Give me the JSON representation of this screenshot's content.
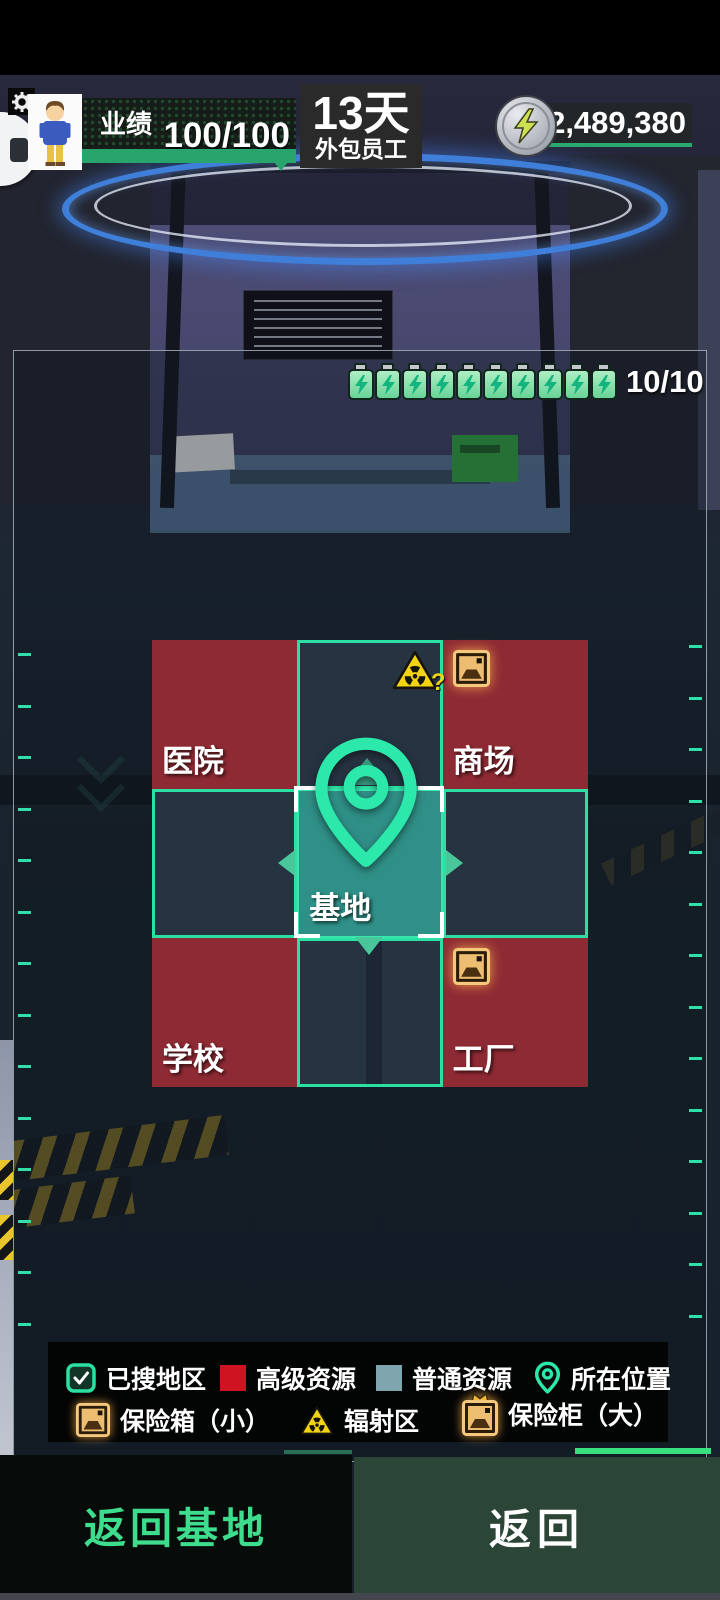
{
  "header": {
    "performance_label": "业绩",
    "performance_value": "100/100",
    "day_count": "13天",
    "day_subtitle": "外包员工",
    "currency_value": "2,489,380"
  },
  "energy": {
    "count": 10,
    "max": 10,
    "text": "10/10"
  },
  "map": {
    "radiation_hint": "?",
    "cells": [
      {
        "row": 0,
        "col": 0,
        "type": "advanced",
        "label": "医院",
        "icons": []
      },
      {
        "row": 0,
        "col": 1,
        "type": "searched",
        "label": "",
        "icons": [
          "radiation-unknown"
        ]
      },
      {
        "row": 0,
        "col": 2,
        "type": "advanced",
        "label": "商场",
        "icons": [
          "safe-small"
        ]
      },
      {
        "row": 1,
        "col": 0,
        "type": "searched",
        "label": "",
        "icons": []
      },
      {
        "row": 1,
        "col": 1,
        "type": "current",
        "label": "基地",
        "icons": []
      },
      {
        "row": 1,
        "col": 2,
        "type": "searched",
        "label": "",
        "icons": []
      },
      {
        "row": 2,
        "col": 0,
        "type": "advanced",
        "label": "学校",
        "icons": []
      },
      {
        "row": 2,
        "col": 1,
        "type": "searched",
        "label": "",
        "icons": []
      },
      {
        "row": 2,
        "col": 2,
        "type": "advanced",
        "label": "工厂",
        "icons": [
          "safe-small"
        ]
      }
    ]
  },
  "legend": {
    "items": [
      {
        "icon": "searched-checkbox",
        "label": "已搜地区"
      },
      {
        "icon": "advanced-swatch",
        "label": "高级资源"
      },
      {
        "icon": "normal-swatch",
        "label": "普通资源"
      },
      {
        "icon": "location-pin",
        "label": "所在位置"
      },
      {
        "icon": "safe-small",
        "label": "保险箱（小）"
      },
      {
        "icon": "radiation",
        "label": "辐射区"
      },
      {
        "icon": "safe-large",
        "label": "保险柜（大）"
      }
    ]
  },
  "footer": {
    "return_base_label": "返回基地",
    "return_label": "返回"
  },
  "colors": {
    "accent_teal": "#2be0a2",
    "advanced_red": "#8e2a33",
    "normal_blue": "#263442",
    "current_teal": "#2f9087",
    "legend_red": "#d01321",
    "legend_blue": "#7fa6af",
    "energy_green": "#27a56d",
    "gold": "#edbd72",
    "radiation_yellow": "#f2d413"
  }
}
